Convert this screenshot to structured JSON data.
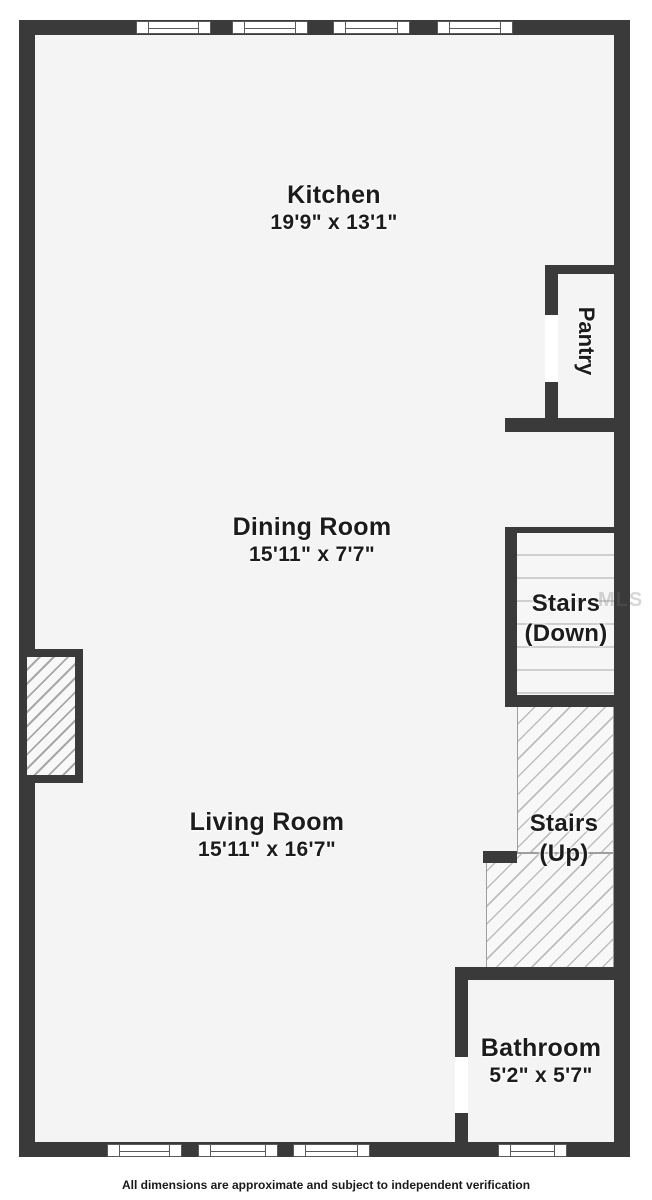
{
  "rooms": {
    "kitchen": {
      "name": "Kitchen",
      "dims": "19'9\" x 13'1\""
    },
    "pantry": {
      "name": "Pantry"
    },
    "dining": {
      "name": "Dining Room",
      "dims": "15'11\" x 7'7\""
    },
    "stairs_down": {
      "line1": "Stairs",
      "line2": "(Down)"
    },
    "stairs_up": {
      "line1": "Stairs",
      "line2": "(Up)"
    },
    "living": {
      "name": "Living Room",
      "dims": "15'11\" x 16'7\""
    },
    "bathroom": {
      "name": "Bathroom",
      "dims": "5'2\" x 5'7\""
    }
  },
  "footer": {
    "disclaimer": "All dimensions are approximate and subject to independent verification"
  },
  "watermark": {
    "text": "MLS"
  },
  "colors": {
    "wall": "#3a3a3a",
    "floor": "#f4f4f4",
    "hatch_line": "#bdbdbd",
    "stair_tread": "#cfcfcf",
    "label_text": "#1c1c1c"
  }
}
